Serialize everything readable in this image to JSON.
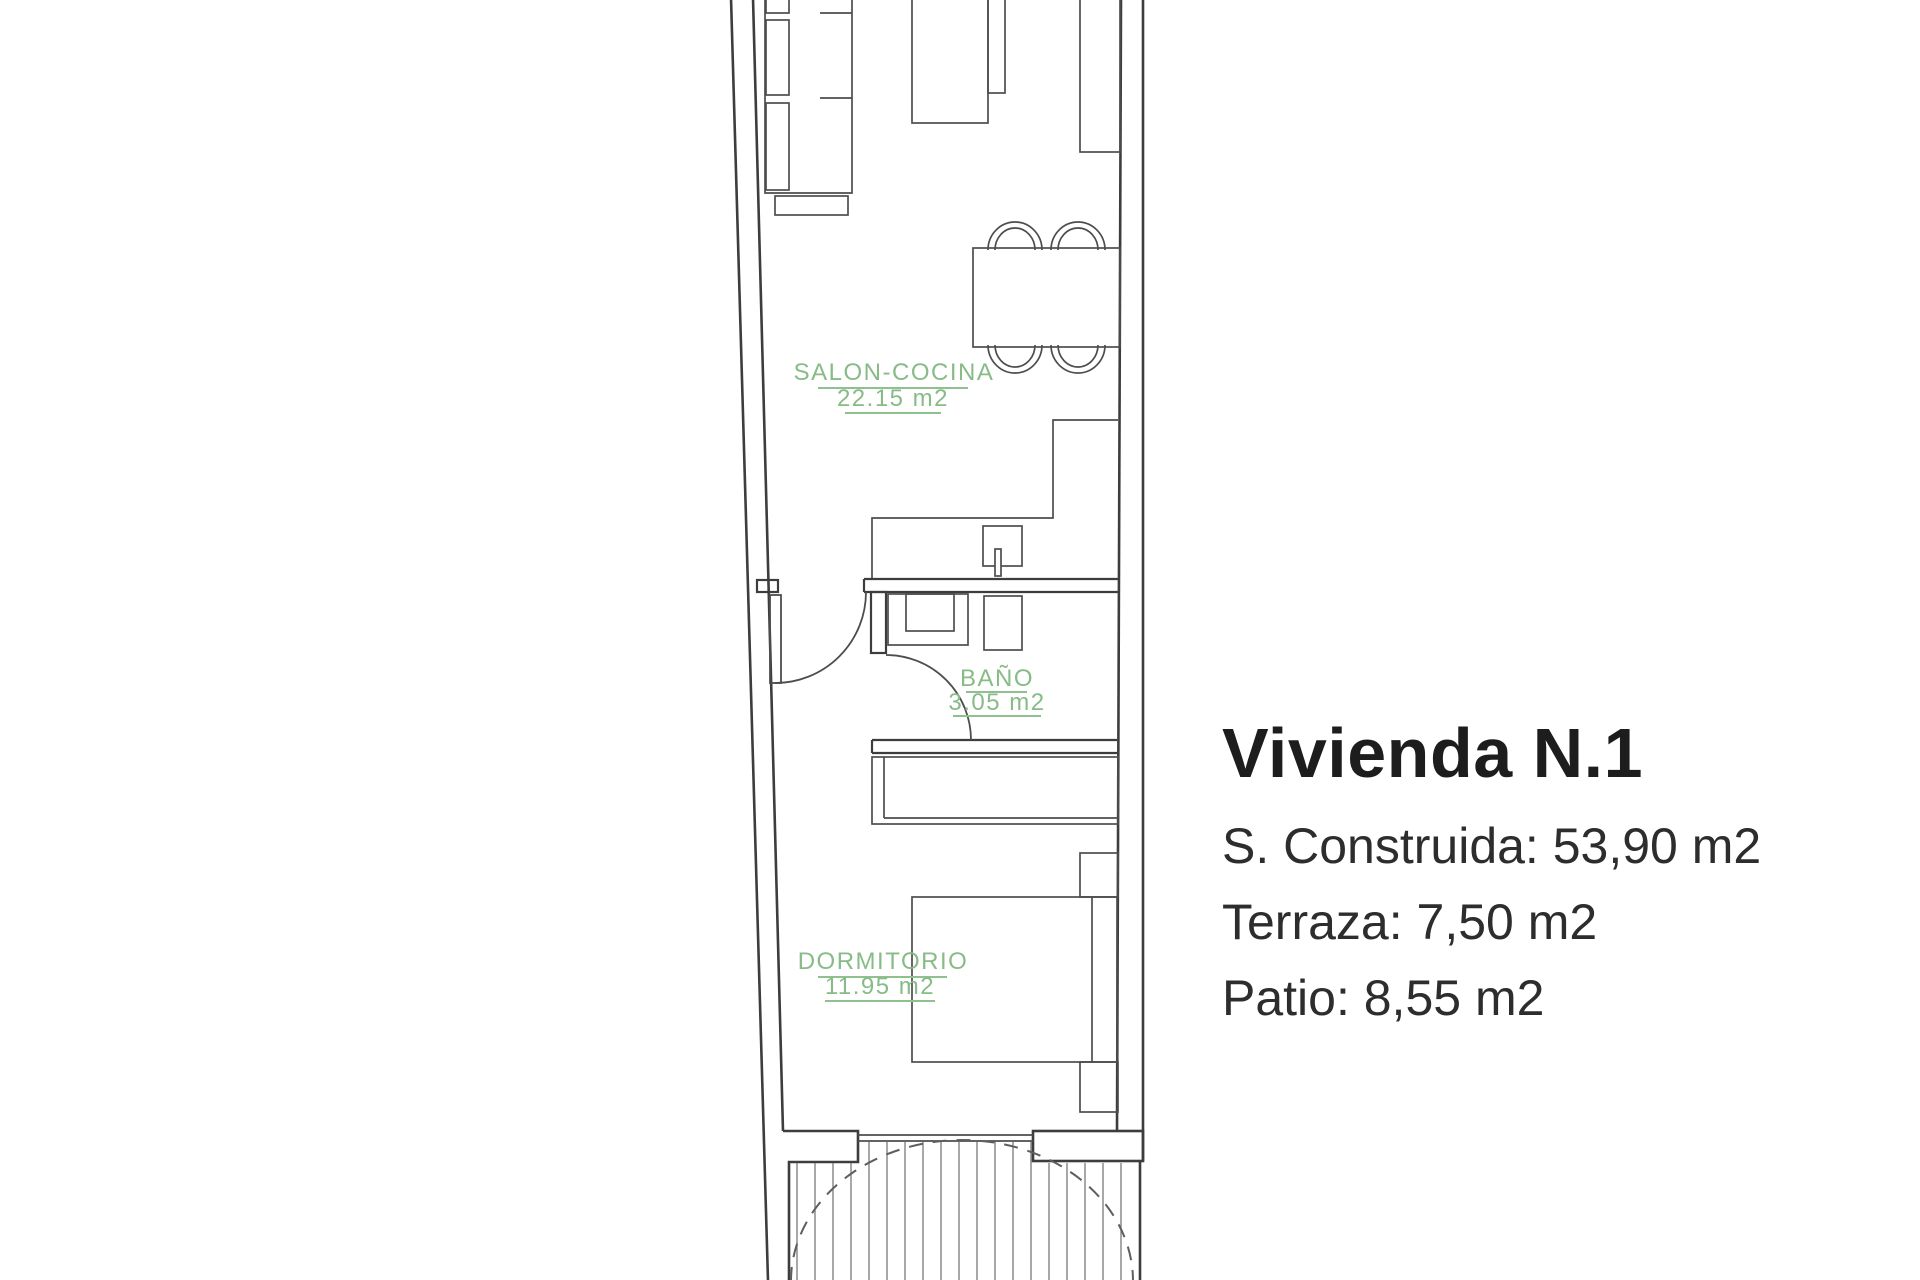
{
  "info_panel": {
    "title": "Vivienda N.1",
    "built_area": "S. Construida: 53,90 m2",
    "terrace": "Terraza: 7,50 m2",
    "patio": "Patio: 8,55 m2"
  },
  "floor_plan": {
    "rooms": [
      {
        "name": "SALON-COCINA",
        "area": "22.15 m2"
      },
      {
        "name": "BAÑO",
        "area": "3.05 m2"
      },
      {
        "name": "DORMITORIO",
        "area": "11.95 m2"
      }
    ],
    "label_color": "#87bb87",
    "wall_color": "#3d3d3d"
  }
}
